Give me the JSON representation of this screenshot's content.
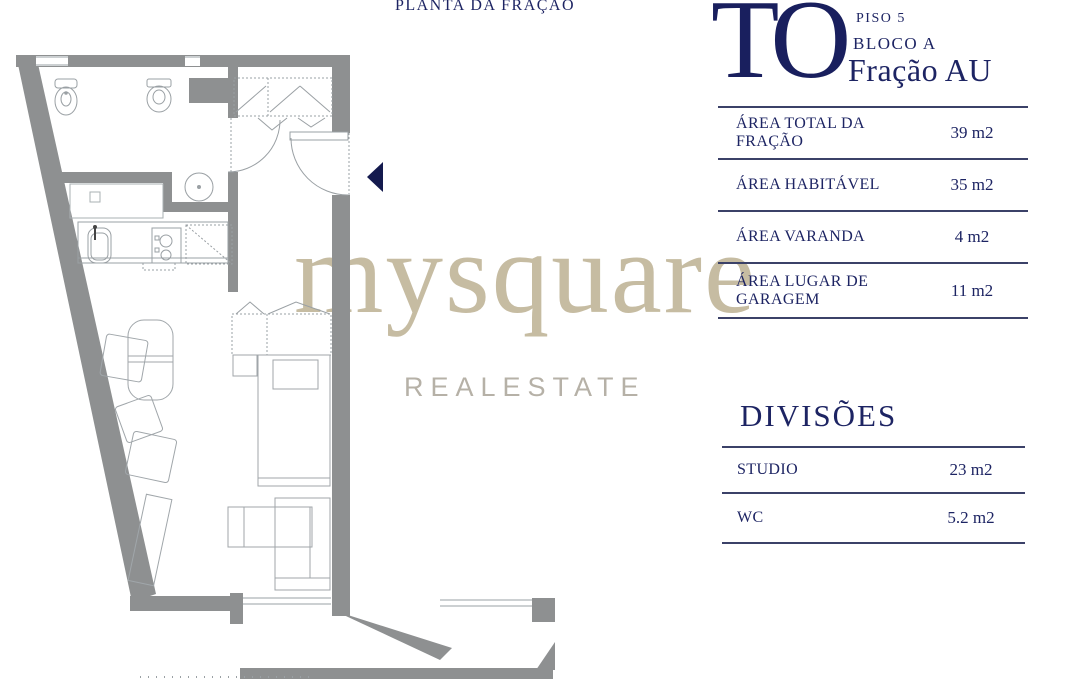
{
  "title": "PLANTA DA FRAÇÃO",
  "header": {
    "logo": "TO",
    "floor": "PISO 5",
    "block": "BLOCO A",
    "unit": "Fração AU"
  },
  "areas_table": {
    "rows": [
      {
        "label": "ÁREA TOTAL DA FRAÇÃO",
        "value": "39 m2"
      },
      {
        "label": "ÁREA HABITÁVEL",
        "value": "35 m2"
      },
      {
        "label": "ÁREA VARANDA",
        "value": "4 m2"
      },
      {
        "label": "ÁREA LUGAR DE GARAGEM",
        "value": "11 m2"
      }
    ]
  },
  "divisions_table": {
    "heading": "DIVISÕES",
    "rows": [
      {
        "label": "STUDIO",
        "value": "23 m2"
      },
      {
        "label": "WC",
        "value": "5.2 m2"
      }
    ]
  },
  "watermark": {
    "brand": "mysquare",
    "subtitle": "REALESTATE"
  },
  "floor_plan": {
    "entrance_marker": "left-pointing-triangle",
    "fixtures": [
      "bidet",
      "toilet",
      "washbasin",
      "laundry-tub",
      "cooktop",
      "refrigerator",
      "closet",
      "wardrobe",
      "bed",
      "nightstand",
      "dining-table",
      "chair",
      "armchair",
      "sideboard",
      "sofa",
      "balcony"
    ]
  },
  "colors": {
    "navy": "#1d2463",
    "wall_gray": "#8e9091",
    "furniture_gray": "#a0a6aa",
    "watermark_tan": "#c6bca2",
    "watermark_gray": "#b6b1a7"
  }
}
